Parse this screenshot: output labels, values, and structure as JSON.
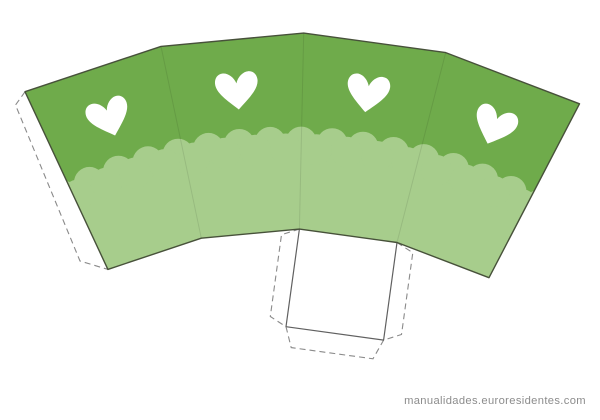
{
  "canvas": {
    "width": 600,
    "height": 420,
    "background": "#ffffff"
  },
  "watermark": {
    "text": "manualidades.euroresidentes.com",
    "color": "#8c8c8c",
    "font_size": 11.2
  },
  "template": {
    "title": "heart-popcorn-box-cutout-template",
    "colors": {
      "band_green": "#6fab4b",
      "scallop_green": "#a7cd8c",
      "outline": "#47513a",
      "square_line": "#606060",
      "dash_line": "#8a8a8a",
      "fold_line": "rgba(0,0,0,0.09)",
      "heart_white": "#ffffff",
      "flap_fill": "#ffffff"
    },
    "strokes": {
      "outline_width": 1.4,
      "square_width": 1.2,
      "dash_width": 1.1,
      "dash_pattern": "6 4"
    },
    "geometry": {
      "center": {
        "x": 290,
        "y": 660
      },
      "outer_radius": 627,
      "inner_radius": 431,
      "start_angle_deg": -25,
      "end_angle_deg": 27.5,
      "panel_count": 4,
      "scallop": {
        "front_radius": 518,
        "back_radius": 511,
        "bump_radius": 15.5,
        "step_deg": 3.43,
        "inner_fill_radius": 420
      },
      "hearts": {
        "radius": 575,
        "scale": 0.92,
        "count": 4
      },
      "band_flap_points": [
        [
          25.0,
          91.8
        ],
        [
          15.5,
          105.0
        ],
        [
          80.0,
          261.0
        ],
        [
          107.8,
          269.4
        ]
      ],
      "bottom_square": {
        "flap_width_side": 17,
        "flap_width_bottom": 20,
        "flap_inset": 8
      }
    }
  }
}
